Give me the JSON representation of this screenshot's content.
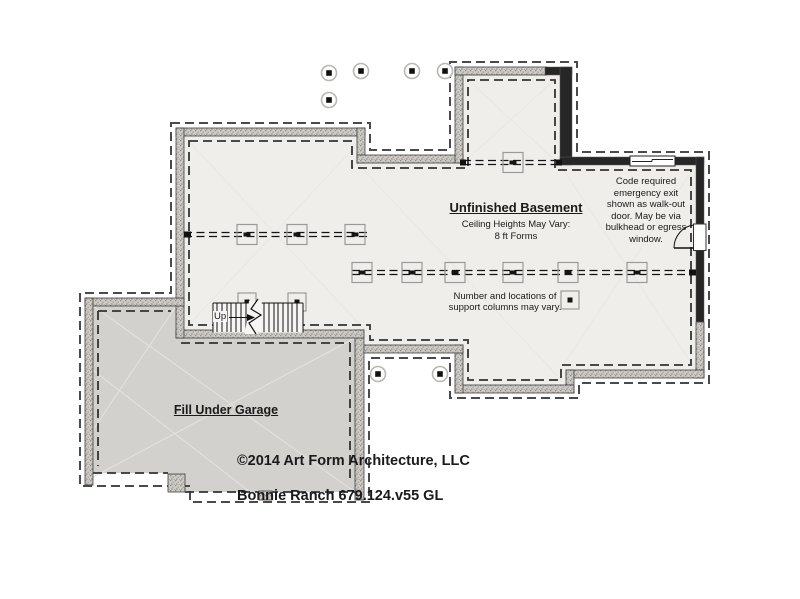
{
  "title_labels": {
    "basement_title": "Unfinished Basement",
    "ceiling_note": "Ceiling Heights May Vary:\n8 ft Forms",
    "garage_label": "Fill Under Garage",
    "stairs_up_label": "Up"
  },
  "notes": {
    "egress_note": "Code required\nemergency exit\nshown as walk-out\ndoor. May be via\nbulkhead or egress\nwindow.",
    "support_columns_note": "Number and locations of\nsupport columns may vary."
  },
  "footer": {
    "copyright_line": "©2014 Art Form Architecture, LLC",
    "plan_id_line": "Bonnie Ranch 679.124.v55 GL"
  },
  "colors": {
    "basement_floor": "#f0eeeb",
    "garage_floor": "#d2d1ce",
    "wall_dark": "#262626",
    "wall_concrete": "#cfccc8",
    "dashed_footing": "#4a4a4a",
    "beam_line": "#141414",
    "column_outline": "#9a9a9a"
  }
}
